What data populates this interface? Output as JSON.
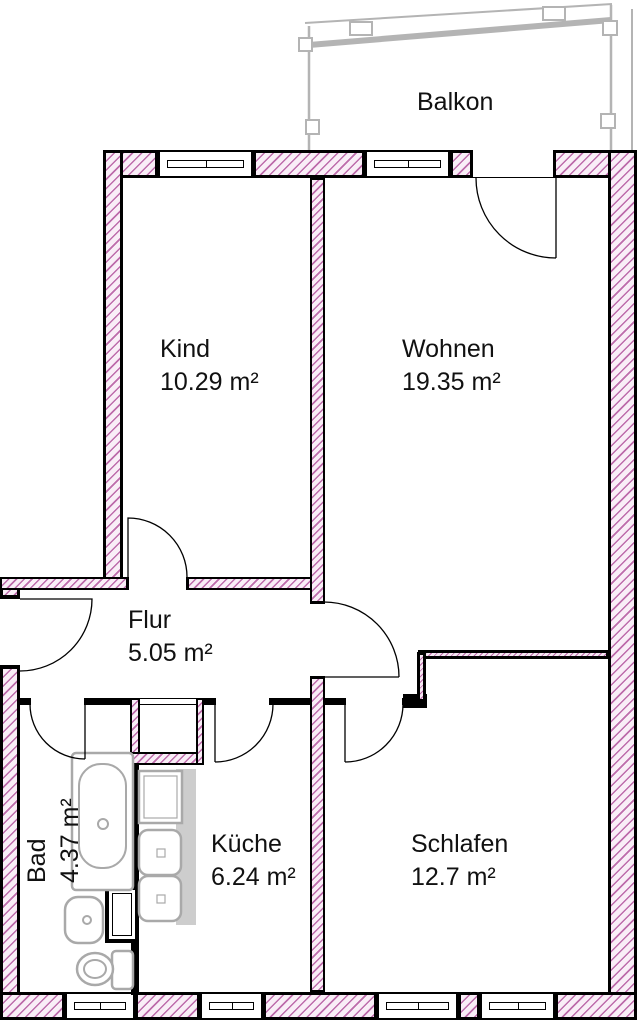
{
  "rooms": [
    {
      "id": "kind",
      "name": "Kind",
      "area": "10.29 m²"
    },
    {
      "id": "wohnen",
      "name": "Wohnen",
      "area": "19.35 m²"
    },
    {
      "id": "flur",
      "name": "Flur",
      "area": "5.05 m²"
    },
    {
      "id": "bad",
      "name": "Bad",
      "area": "4.37 m²"
    },
    {
      "id": "kueche",
      "name": "Küche",
      "area": "6.24 m²"
    },
    {
      "id": "schlafen",
      "name": "Schlafen",
      "area": "12.7 m²"
    },
    {
      "id": "balkon",
      "name": "Balkon"
    }
  ],
  "colors": {
    "wall_hatch": "#bd6cab",
    "wall_fill": "#f9eef7",
    "outline": "#000000",
    "fixture_gray": "#a9a9a9",
    "balcony_gray": "#b4b4b4",
    "label_text": "#111111"
  }
}
